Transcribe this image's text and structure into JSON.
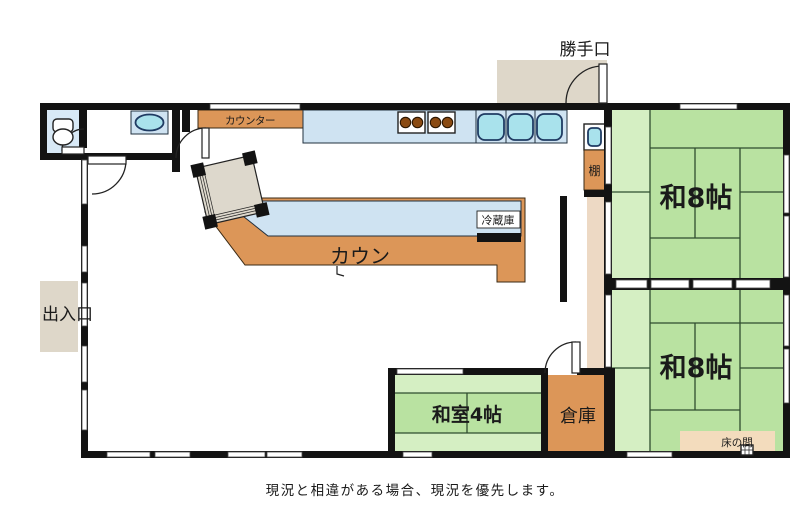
{
  "labels": {
    "back_door": "勝手口",
    "entrance": "出入口",
    "counter_small": "カウンター",
    "counter_large": "カウン",
    "fridge": "冷蔵庫",
    "shelf": "棚",
    "room_8_upper": "和8帖",
    "room_8_lower": "和8帖",
    "room_4": "和室4帖",
    "storage": "倉庫",
    "tokonoma": "床の間",
    "caption": "現況と相違がある場合、現況を優先します。"
  },
  "colors": {
    "wall": "#131313",
    "tatami_green": "#b9e2a1",
    "tatami_green_light": "#d5efc3",
    "counter_orange": "#dc9658",
    "counter_blue": "#cfe3f2",
    "sink_blue": "#a9e2ec",
    "toilet_room_blue": "#d8e9f6",
    "porch_beige": "#ded7c9",
    "hall_strip_beige": "#edd9c4",
    "tokonoma_beige": "#f3dcbd",
    "table_beige": "#ddd8cc",
    "burner_brown": "#8a4a12"
  }
}
